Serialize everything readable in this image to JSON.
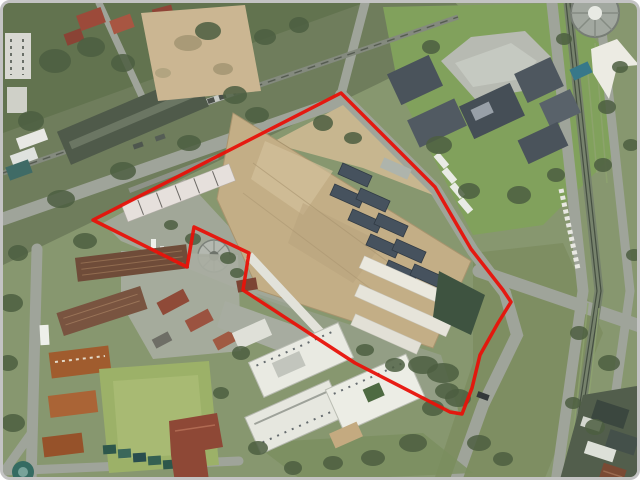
{
  "image": {
    "kind": "aerial-satellite-photograph",
    "description": "Aerial photo of an urban industrial block; a large tan-roofed factory complex is outlined with a red property boundary. A railway corridor crosses the upper left, a modern campus with a round structure sits top right, a tree-lined boulevard runs down the right side, brick barracks-style buildings and white apartment slabs fill the lower half."
  },
  "frame": {
    "border_color": "#c3c3c3",
    "corner_radius": "10px",
    "background": "#ffffff"
  },
  "annotation": {
    "boundary_color": "#e8120a",
    "boundary_width": "3.5",
    "boundary_points": "338,90 432,184 468,246 500,287 508,299 495,320 477,352 469,385 459,411 447,409 352,360 240,287 246,250 191,224 184,264 90,217"
  },
  "palette": {
    "vegetation_base": "#87976f",
    "dark_trees": "#4c5e41",
    "road_grey": "#9fa49a",
    "factory_roof_tan": "#c3ae86",
    "rooftop_vent_slate": "#46525e",
    "white_building": "#e9eae2",
    "brick_roof": "#8f4a38",
    "orange_roof": "#a05c2e",
    "pool_teal": "#37788a",
    "rail_strip": "#76826c"
  }
}
